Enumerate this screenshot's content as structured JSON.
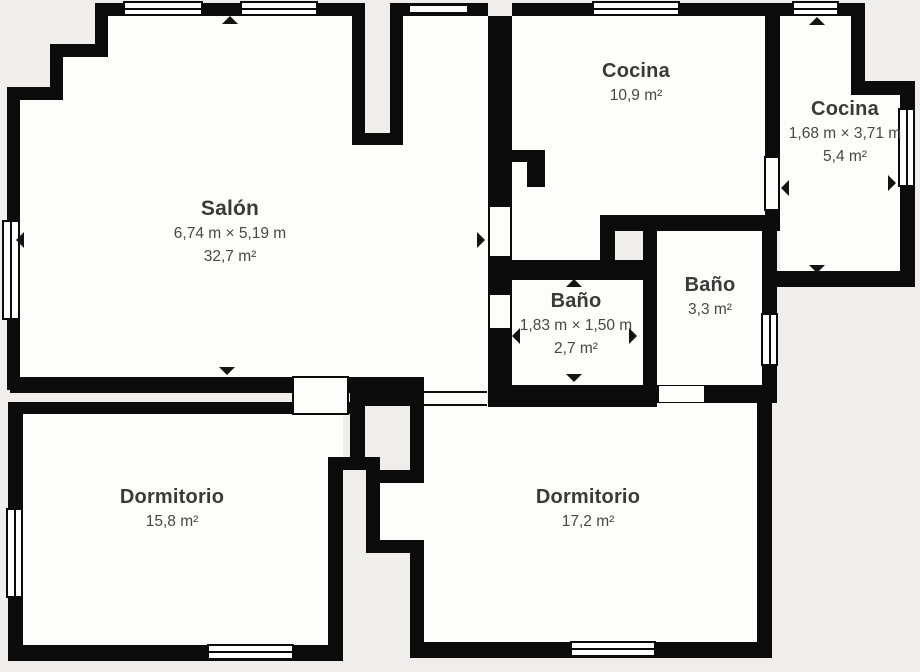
{
  "plan_title": "Floor plan",
  "colors": {
    "wall": "#0b0b0b",
    "room_fill": "#fdfdfc",
    "exterior": "#efeeeb",
    "text_primary": "#3a3a3a",
    "text_secondary": "#474747"
  },
  "rooms": [
    {
      "id": "salon",
      "name": "Salón",
      "dimensions": "6,74 m × 5,19 m",
      "area": "32,7 m²"
    },
    {
      "id": "cocina-1",
      "name": "Cocina",
      "area": "10,9 m²"
    },
    {
      "id": "cocina-2",
      "name": "Cocina",
      "dimensions": "1,68 m × 3,71 m",
      "area": "5,4 m²"
    },
    {
      "id": "bano-1",
      "name": "Baño",
      "dimensions": "1,83 m × 1,50 m",
      "area": "2,7 m²"
    },
    {
      "id": "bano-2",
      "name": "Baño",
      "area": "3,3 m²"
    },
    {
      "id": "dormitorio-1",
      "name": "Dormitorio",
      "area": "15,8 m²"
    },
    {
      "id": "dormitorio-2",
      "name": "Dormitorio",
      "area": "17,2 m²"
    }
  ]
}
